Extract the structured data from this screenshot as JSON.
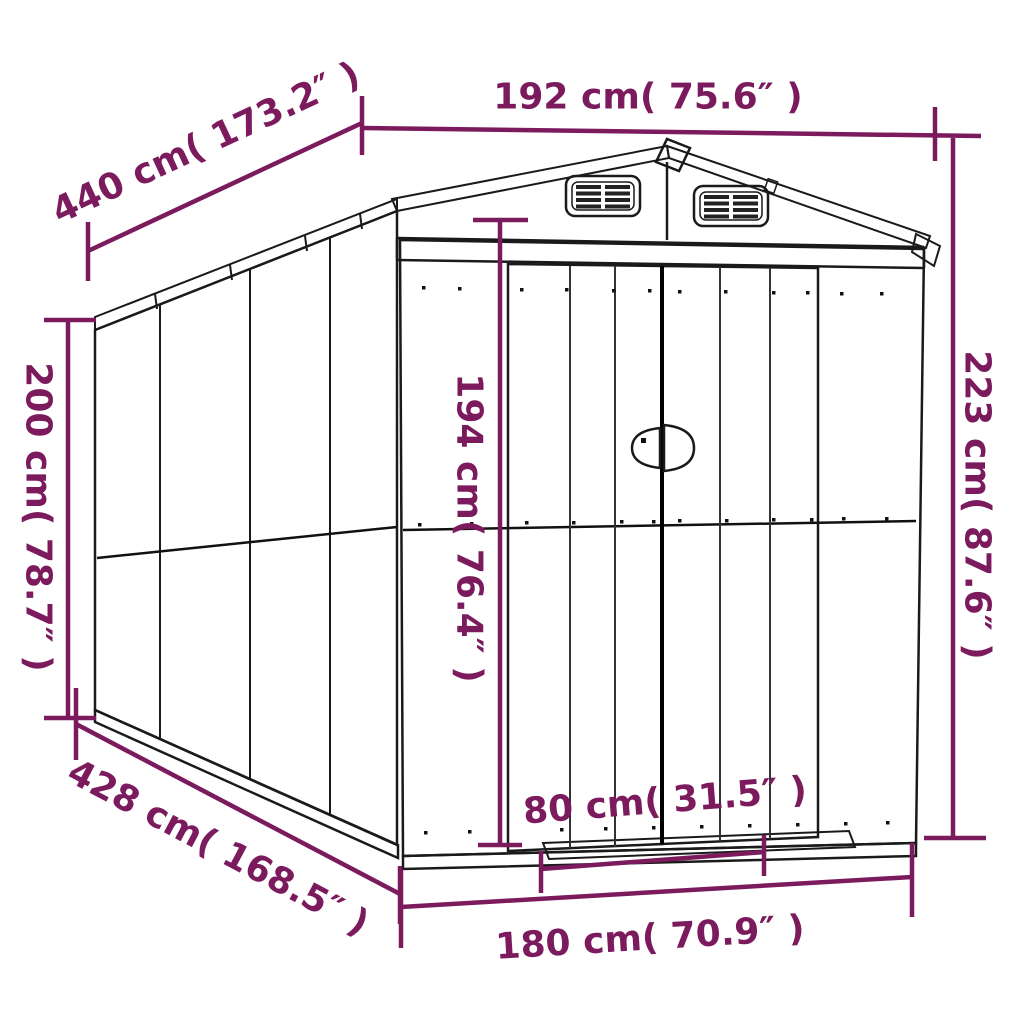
{
  "diagram": {
    "title": "Garden shed dimension diagram",
    "style": "black line drawing with magenta dimension annotations",
    "accent_color": "#7B1B5E",
    "line_color": "#1a1a1a",
    "background_color": "#ffffff"
  },
  "dimensions": {
    "roof_depth": "440 cm( 173.2″ )",
    "roof_width": "192 cm( 75.6″ )",
    "total_height": "223 cm( 87.6″ )",
    "wall_height": "200 cm( 78.7″ )",
    "door_height": "194 cm( 76.4″ )",
    "base_depth": "428 cm( 168.5″ )",
    "door_width": "80 cm( 31.5″ )",
    "base_width": "180 cm( 70.9″ )"
  }
}
